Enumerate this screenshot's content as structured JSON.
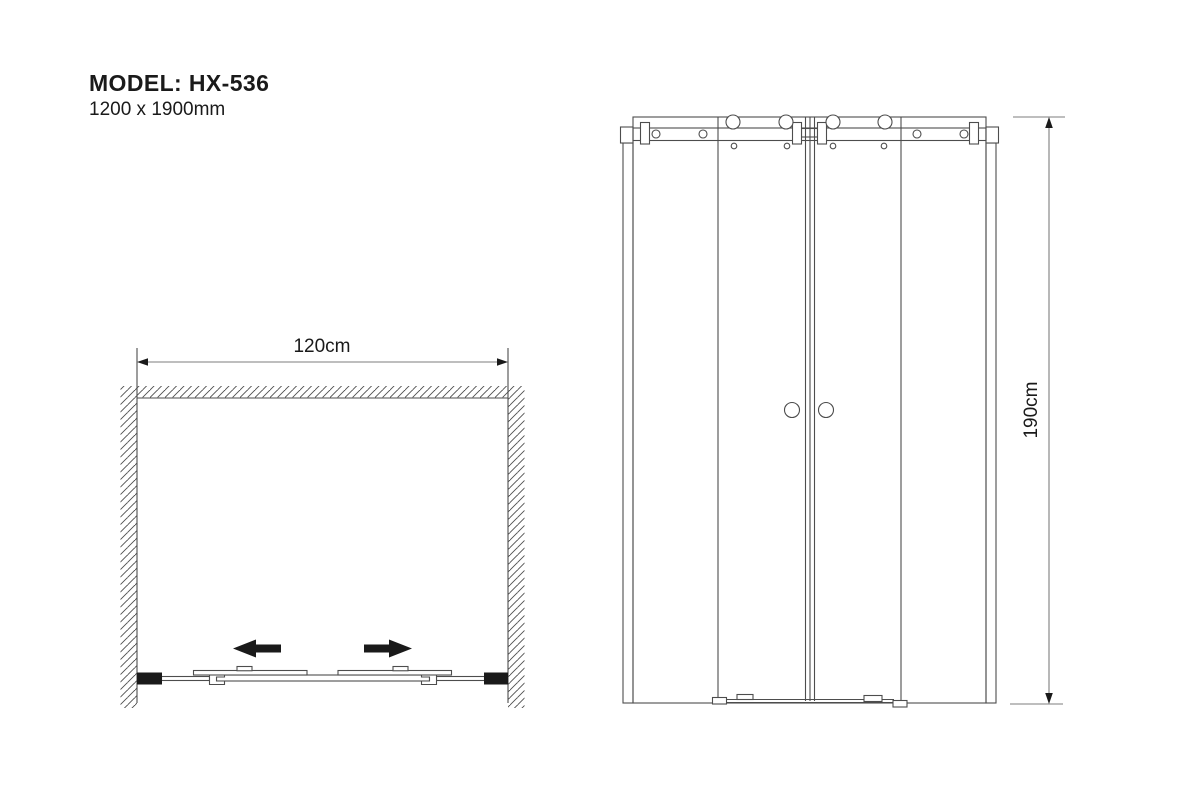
{
  "colors": {
    "background": "#ffffff",
    "line": "#4d4d4d",
    "dim_line": "#7d7d7d",
    "ink": "#1a1a1a",
    "text": "#1a1a1a"
  },
  "title_block": {
    "model": "MODEL: HX-536",
    "dimensions": "1200 x 1900mm"
  },
  "plan_view": {
    "width_label": "120cm"
  },
  "elevation_view": {
    "height_label": "190cm"
  }
}
